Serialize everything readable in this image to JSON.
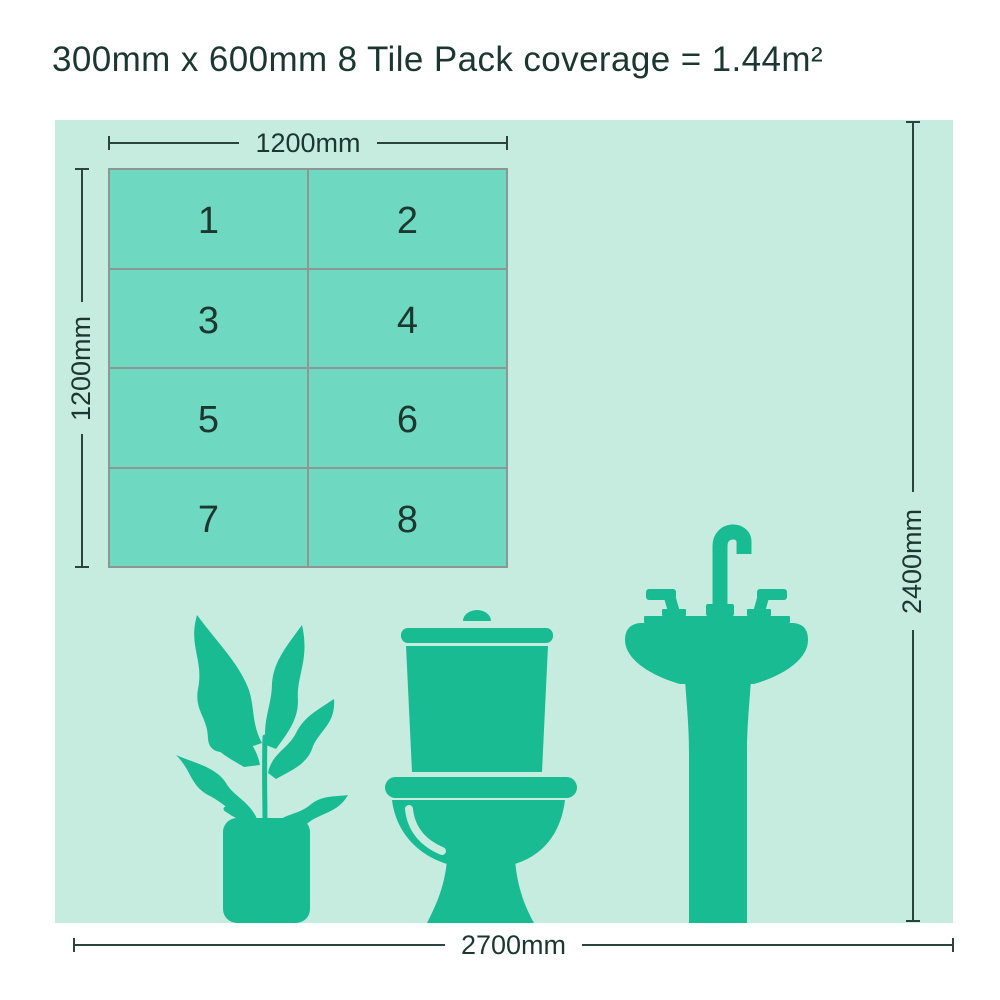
{
  "title": "300mm x 600mm 8 Tile Pack coverage = 1.44m²",
  "grid": {
    "rows": 4,
    "columns": 2,
    "tiles": [
      "1",
      "2",
      "3",
      "4",
      "5",
      "6",
      "7",
      "8"
    ]
  },
  "room": {
    "dim_top": "1200mm",
    "dim_left": "1200mm",
    "dim_right": "2400mm",
    "dim_bottom": "2700mm"
  },
  "icons": {
    "plant": "plant-icon",
    "toilet": "toilet-icon",
    "sink": "sink-icon"
  },
  "colors": {
    "page_bg": "#ffffff",
    "room_bg": "#c6ece0",
    "tile_fill": "#6fd8c0",
    "grid_line": "#8d9894",
    "icon_green": "#19bc92",
    "dim_line": "#2b443d",
    "text_dark": "#1c372f"
  }
}
